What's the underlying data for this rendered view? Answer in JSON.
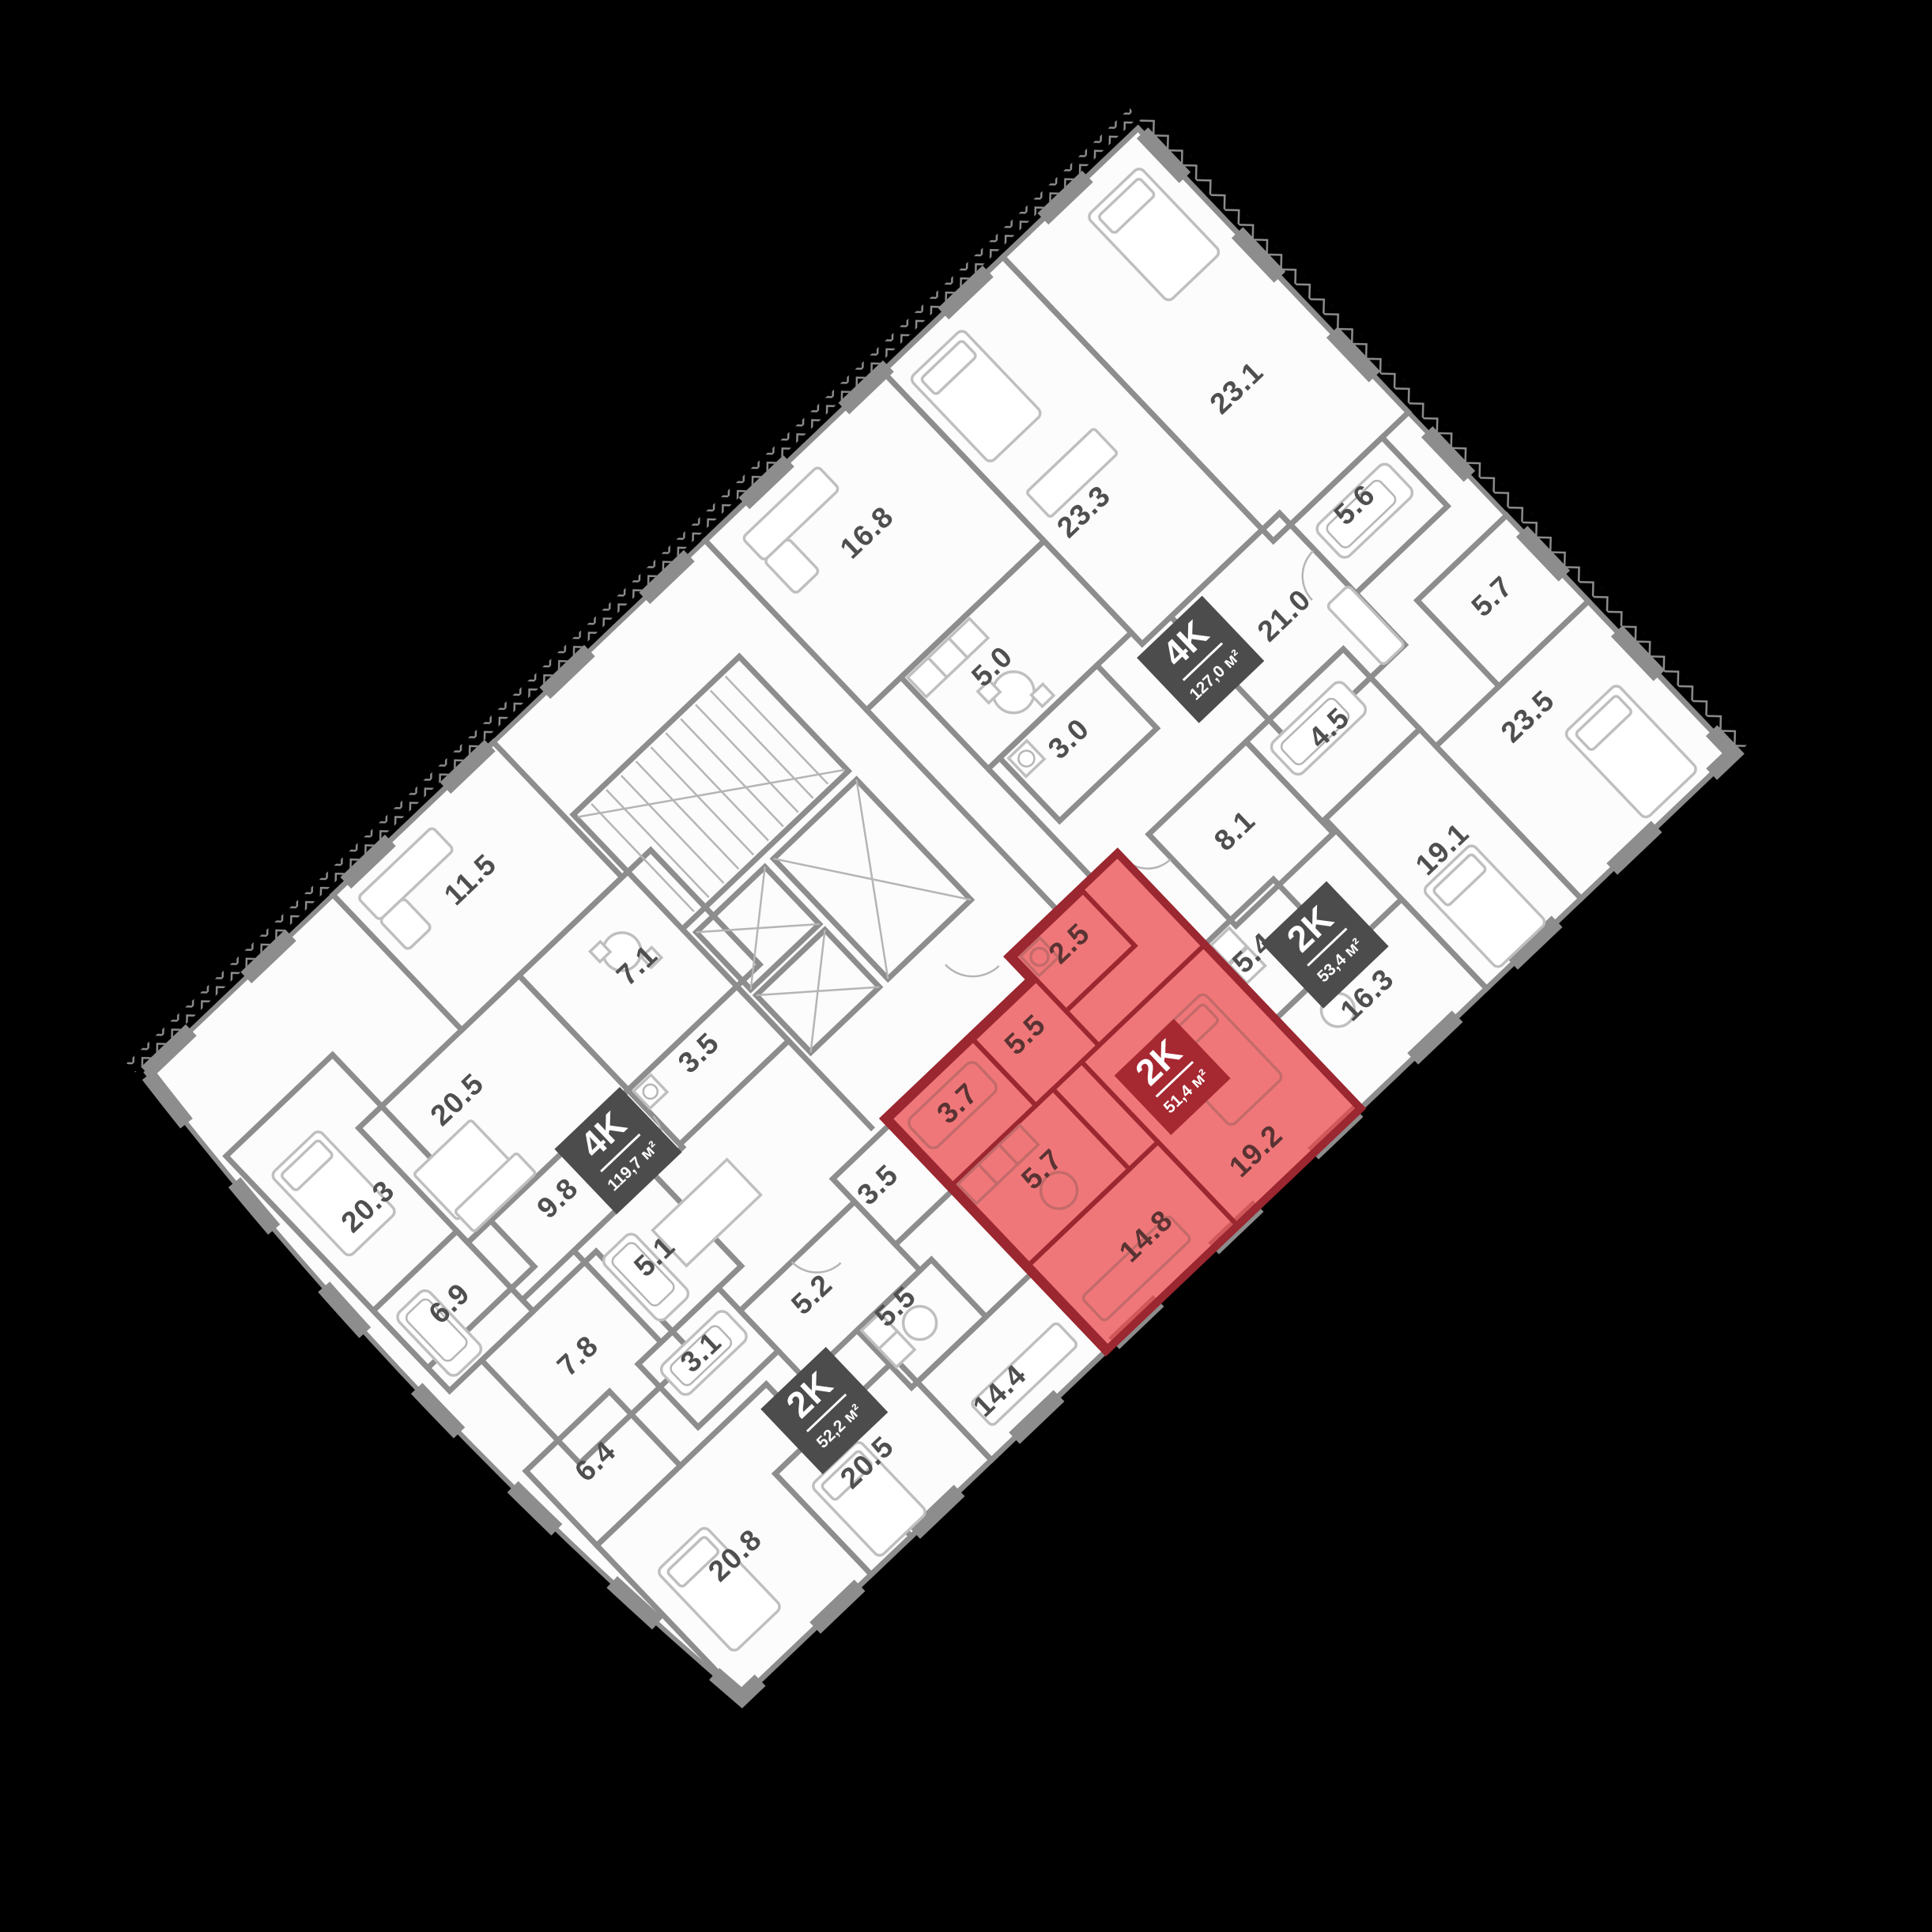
{
  "meta": {
    "type": "floor-plan",
    "language": "ru"
  },
  "colors": {
    "background": "#000000",
    "floor": "#fcfcfc",
    "walls": "#8d8d8d",
    "furniture": "#bfbfbf",
    "label": "#4f4f4f",
    "badge_bg": "#4c4c4c",
    "badge_text": "#ffffff",
    "highlight_fill": "rgba(235,68,70,0.72)",
    "highlight_wall": "#9b2730",
    "highlight_badge_bg": "#a62831",
    "highlight_label": "#5a3333"
  },
  "floor_plan": {
    "apartments": [
      {
        "id": "apt-4k-119",
        "badge": {
          "type": "4K",
          "area": "119,7 м²"
        },
        "highlighted": false,
        "rooms": [
          "11.5",
          "20.5",
          "20.3",
          "7.1",
          "3.5",
          "9.8",
          "5.1",
          "6.9",
          "7.8",
          "6.4",
          "20.8"
        ]
      },
      {
        "id": "apt-2k-52",
        "badge": {
          "type": "2K",
          "area": "52,2 м²"
        },
        "highlighted": false,
        "rooms": [
          "5.2",
          "3.1",
          "3.5",
          "5.5",
          "20.5",
          "14.4"
        ]
      },
      {
        "id": "apt-2k-51",
        "badge": {
          "type": "2K",
          "area": "51,4 м²"
        },
        "highlighted": true,
        "rooms": [
          "3.7",
          "5.5",
          "2.5",
          "5.7",
          "14.8",
          "19.2"
        ]
      },
      {
        "id": "apt-2k-53",
        "badge": {
          "type": "2K",
          "area": "53,4 м²"
        },
        "highlighted": false,
        "rooms": [
          "8.1",
          "4.5",
          "5.4",
          "16.3",
          "19.1"
        ]
      },
      {
        "id": "apt-4k-127",
        "badge": {
          "type": "4K",
          "area": "127,0 м²"
        },
        "highlighted": false,
        "rooms": [
          "16.8",
          "23.3",
          "5.0",
          "3.0",
          "23.1",
          "5.6",
          "21.0",
          "5.7",
          "23.5"
        ]
      }
    ]
  }
}
